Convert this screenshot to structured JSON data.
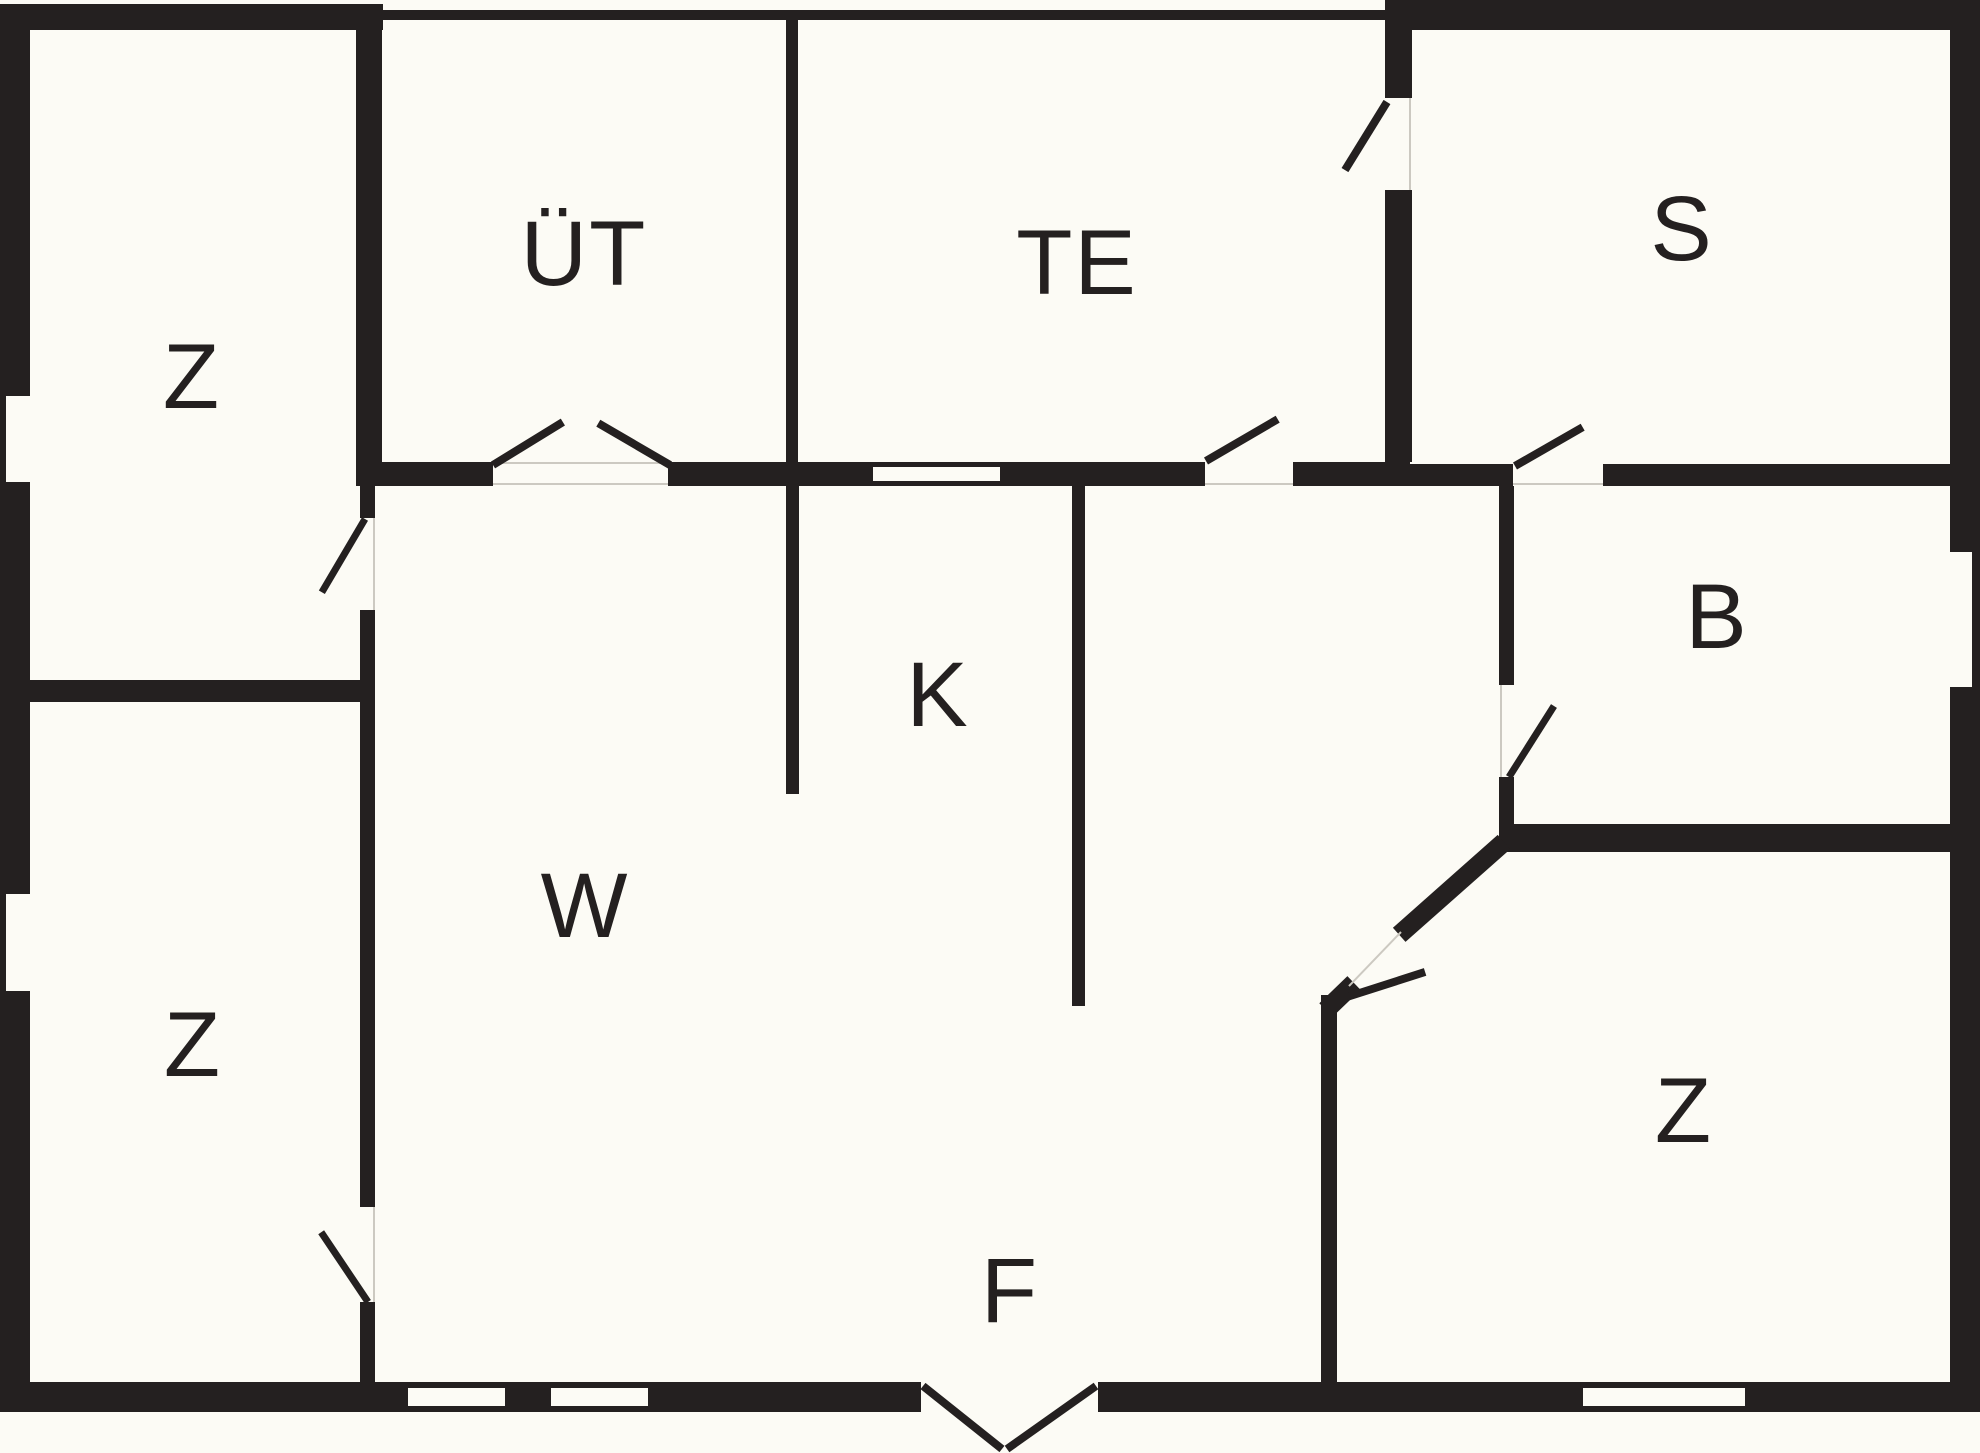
{
  "title": "floor-plan",
  "colors": {
    "background": "#fcfbf5",
    "wall": "#242020",
    "label": "#242020",
    "window": "#fcfbf5",
    "hairline": "#ccc9c1"
  },
  "rooms": [
    {
      "id": "room-z-top-left",
      "label": "Z",
      "x": 192,
      "y": 377
    },
    {
      "id": "room-ut",
      "label": "ÜT",
      "x": 584,
      "y": 254
    },
    {
      "id": "room-te",
      "label": "TE",
      "x": 1077,
      "y": 263
    },
    {
      "id": "room-s",
      "label": "S",
      "x": 1682,
      "y": 229
    },
    {
      "id": "room-k",
      "label": "K",
      "x": 938,
      "y": 695
    },
    {
      "id": "room-w",
      "label": "W",
      "x": 585,
      "y": 906
    },
    {
      "id": "room-b",
      "label": "B",
      "x": 1717,
      "y": 617
    },
    {
      "id": "room-z-bottom-left",
      "label": "Z",
      "x": 193,
      "y": 1045
    },
    {
      "id": "room-z-bottom-right",
      "label": "Z",
      "x": 1684,
      "y": 1111
    },
    {
      "id": "room-f",
      "label": "F",
      "x": 1010,
      "y": 1291
    }
  ],
  "structure": {
    "walls": [
      {
        "name": "exterior-wall-top-left",
        "x": 0,
        "y": 4,
        "w": 383,
        "h": 26
      },
      {
        "name": "exterior-wall-top-middle",
        "x": 381,
        "y": 10,
        "w": 1004,
        "h": 10
      },
      {
        "name": "exterior-wall-top-right",
        "x": 1385,
        "y": 0,
        "w": 595,
        "h": 30
      },
      {
        "name": "exterior-wall-left",
        "x": 0,
        "y": 4,
        "w": 30,
        "h": 1408
      },
      {
        "name": "exterior-wall-right",
        "x": 1950,
        "y": 0,
        "w": 30,
        "h": 1412
      },
      {
        "name": "exterior-wall-bottom-left",
        "x": 0,
        "y": 1382,
        "w": 921,
        "h": 30
      },
      {
        "name": "exterior-wall-bottom-right",
        "x": 1098,
        "y": 1382,
        "w": 882,
        "h": 30
      },
      {
        "name": "wall-z-ut",
        "x": 356,
        "y": 11,
        "w": 26,
        "h": 455
      },
      {
        "name": "wall-ut-te-divider",
        "x": 786,
        "y": 11,
        "w": 12,
        "h": 455
      },
      {
        "name": "wall-ut-bottom",
        "x": 356,
        "y": 462,
        "w": 137,
        "h": 24
      },
      {
        "name": "wall-ut-te-bottom",
        "x": 668,
        "y": 462,
        "w": 537,
        "h": 24
      },
      {
        "name": "wall-te-bottom-right",
        "x": 1293,
        "y": 462,
        "w": 117,
        "h": 24
      },
      {
        "name": "wall-w-z-upper",
        "x": 360,
        "y": 462,
        "w": 15,
        "h": 56
      },
      {
        "name": "wall-w-z-middle",
        "x": 360,
        "y": 610,
        "w": 15,
        "h": 597
      },
      {
        "name": "wall-w-z-lower",
        "x": 360,
        "y": 1302,
        "w": 15,
        "h": 80
      },
      {
        "name": "wall-z-z-divider",
        "x": 30,
        "y": 680,
        "w": 345,
        "h": 22
      },
      {
        "name": "wall-k-left",
        "x": 786,
        "y": 486,
        "w": 13,
        "h": 308
      },
      {
        "name": "wall-k-right",
        "x": 1072,
        "y": 486,
        "w": 13,
        "h": 520
      },
      {
        "name": "wall-s-left-upper",
        "x": 1385,
        "y": 0,
        "w": 27,
        "h": 98
      },
      {
        "name": "wall-s-left-lower",
        "x": 1385,
        "y": 190,
        "w": 27,
        "h": 272
      },
      {
        "name": "wall-s-bottom-left",
        "x": 1410,
        "y": 464,
        "w": 103,
        "h": 22
      },
      {
        "name": "wall-s-bottom-right",
        "x": 1603,
        "y": 464,
        "w": 347,
        "h": 22
      },
      {
        "name": "wall-b-left-upper",
        "x": 1499,
        "y": 486,
        "w": 15,
        "h": 199
      },
      {
        "name": "wall-b-left-lower",
        "x": 1499,
        "y": 777,
        "w": 15,
        "h": 75
      },
      {
        "name": "wall-b-bottom",
        "x": 1499,
        "y": 824,
        "w": 451,
        "h": 28
      },
      {
        "name": "wall-f-z-vertical",
        "x": 1321,
        "y": 995,
        "w": 16,
        "h": 387
      }
    ],
    "diagonal_walls": [
      {
        "name": "wall-diagonal-upper",
        "x1": 1504,
        "y1": 842,
        "x2": 1399,
        "y2": 935,
        "t": 19
      },
      {
        "name": "wall-diagonal-lower",
        "x1": 1354,
        "y1": 983,
        "x2": 1326,
        "y2": 1010,
        "t": 19
      }
    ],
    "windows": [
      {
        "name": "window-left-upper",
        "x": 6,
        "y": 396,
        "w": 24,
        "h": 86
      },
      {
        "name": "window-left-lower",
        "x": 6,
        "y": 894,
        "w": 24,
        "h": 97
      },
      {
        "name": "window-right-b",
        "x": 1950,
        "y": 552,
        "w": 22,
        "h": 135
      },
      {
        "name": "window-bottom-1",
        "x": 408,
        "y": 1388,
        "w": 97,
        "h": 18
      },
      {
        "name": "window-bottom-2",
        "x": 551,
        "y": 1388,
        "w": 97,
        "h": 18
      },
      {
        "name": "window-bottom-3",
        "x": 1583,
        "y": 1388,
        "w": 162,
        "h": 18
      },
      {
        "name": "window-te-hatch",
        "x": 873,
        "y": 467,
        "w": 127,
        "h": 14
      }
    ],
    "door_leaves": [
      {
        "name": "door-z-top-leaf",
        "x1": 365,
        "y1": 519,
        "x2": 322,
        "y2": 592,
        "t": 7
      },
      {
        "name": "door-z-bottom-leaf",
        "x1": 368,
        "y1": 1302,
        "x2": 321,
        "y2": 1232,
        "t": 7
      },
      {
        "name": "door-ut-left-leaf",
        "x1": 493,
        "y1": 465,
        "x2": 563,
        "y2": 422,
        "t": 8
      },
      {
        "name": "door-ut-right-leaf",
        "x1": 670,
        "y1": 465,
        "x2": 598,
        "y2": 423,
        "t": 8
      },
      {
        "name": "door-te-leaf",
        "x1": 1206,
        "y1": 461,
        "x2": 1278,
        "y2": 419,
        "t": 8
      },
      {
        "name": "door-te-s-leaf",
        "x1": 1387,
        "y1": 102,
        "x2": 1345,
        "y2": 170,
        "t": 8
      },
      {
        "name": "door-s-leaf",
        "x1": 1515,
        "y1": 466,
        "x2": 1583,
        "y2": 427,
        "t": 8
      },
      {
        "name": "door-b-leaf",
        "x1": 1509,
        "y1": 777,
        "x2": 1554,
        "y2": 706,
        "t": 7
      },
      {
        "name": "door-diagonal-leaf",
        "x1": 1347,
        "y1": 997,
        "x2": 1425,
        "y2": 972,
        "t": 8
      }
    ],
    "hairlines": [
      {
        "name": "gapline-ut-top",
        "x1": 493,
        "y1": 463,
        "x2": 668,
        "y2": 463,
        "t": 2
      },
      {
        "name": "gapline-ut-bottom",
        "x1": 493,
        "y1": 484,
        "x2": 668,
        "y2": 484,
        "t": 2
      },
      {
        "name": "gapline-z-top",
        "x1": 374,
        "y1": 518,
        "x2": 374,
        "y2": 610,
        "t": 2
      },
      {
        "name": "gapline-z-bottom",
        "x1": 374,
        "y1": 1207,
        "x2": 374,
        "y2": 1302,
        "t": 2
      },
      {
        "name": "gapline-te",
        "x1": 1205,
        "y1": 484,
        "x2": 1293,
        "y2": 484,
        "t": 2
      },
      {
        "name": "gapline-te-s",
        "x1": 1410,
        "y1": 98,
        "x2": 1410,
        "y2": 190,
        "t": 2
      },
      {
        "name": "gapline-s",
        "x1": 1513,
        "y1": 484,
        "x2": 1603,
        "y2": 484,
        "t": 2
      },
      {
        "name": "gapline-b",
        "x1": 1501,
        "y1": 685,
        "x2": 1501,
        "y2": 777,
        "t": 2
      },
      {
        "name": "gapline-diagonal",
        "x1": 1401,
        "y1": 932,
        "x2": 1349,
        "y2": 986,
        "t": 2
      }
    ],
    "porch_lines": [
      {
        "name": "porch-line-left",
        "x1": 923,
        "y1": 1386,
        "x2": 1002,
        "y2": 1449,
        "t": 8
      },
      {
        "name": "porch-line-right",
        "x1": 1096,
        "y1": 1386,
        "x2": 1007,
        "y2": 1449,
        "t": 8
      }
    ]
  }
}
